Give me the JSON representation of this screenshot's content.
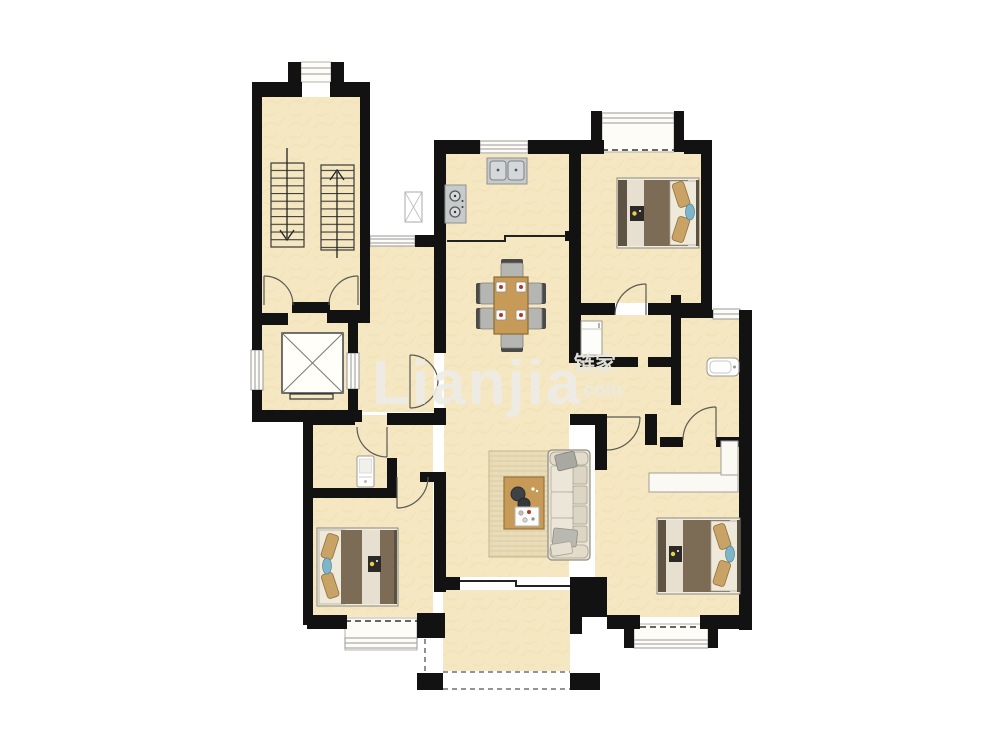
{
  "watermark": {
    "brand": "Lianjia",
    "cjk": "链家",
    "domain": ".com"
  },
  "palette": {
    "wall": "#121212",
    "floor": "#f4e7c2",
    "floor_line": "#eedfae",
    "bay": "#fdfcf6",
    "bay_edge": "#b3b3ab",
    "arc": "#5a5a55",
    "wood": "#c79b57",
    "wood_edge": "#8a6b34",
    "duvet": "#7d6c55",
    "duvet_dark": "#5f5343",
    "cream": "#e7e0d0",
    "bedbase": "#f0ede3",
    "pillow": "#c9a265",
    "pillow_edge": "#8f7040",
    "teal": "#7fb5c9",
    "sofa": "#eae4d6",
    "sofa_edge": "#908d7f",
    "cushion": "#ddd5c3",
    "rug": "#e9dcb9",
    "rug_edge": "#cbbd94",
    "appliance": "#c6cacb",
    "appliance_edge": "#8d9192",
    "chair": "#b5b6b2",
    "chair_back": "#4a4b48",
    "plate_red": "#b3382c",
    "fixture": "#ffffff",
    "fixture_edge": "#9a9a92",
    "wm": "#edece6"
  }
}
